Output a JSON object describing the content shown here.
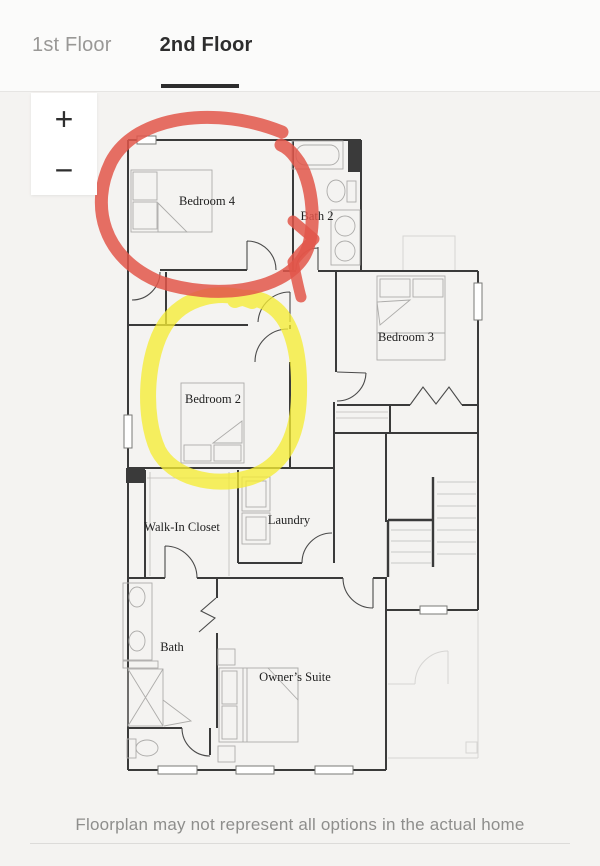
{
  "header": {
    "tabs": [
      {
        "label": "1st Floor",
        "active": false
      },
      {
        "label": "2nd Floor",
        "active": true
      }
    ]
  },
  "zoom_controls": {
    "zoom_in_label": "+",
    "zoom_out_label": "−"
  },
  "floorplan": {
    "rooms": {
      "bedroom4": "Bedroom 4",
      "bath2": "Bath 2",
      "bedroom3": "Bedroom 3",
      "bedroom2": "Bedroom 2",
      "walk_in_closet": "Walk-In Closet",
      "laundry": "Laundry",
      "bath": "Bath",
      "owners_suite": "Owner’s Suite"
    }
  },
  "annotations": {
    "red_circle": {
      "color": "#e2564a",
      "around": "Bedroom 4"
    },
    "yellow_circle": {
      "color": "#f5ec35",
      "around": "Bedroom 2"
    }
  },
  "footer": {
    "disclaimer": "Floorplan may not represent all options in the actual home"
  }
}
